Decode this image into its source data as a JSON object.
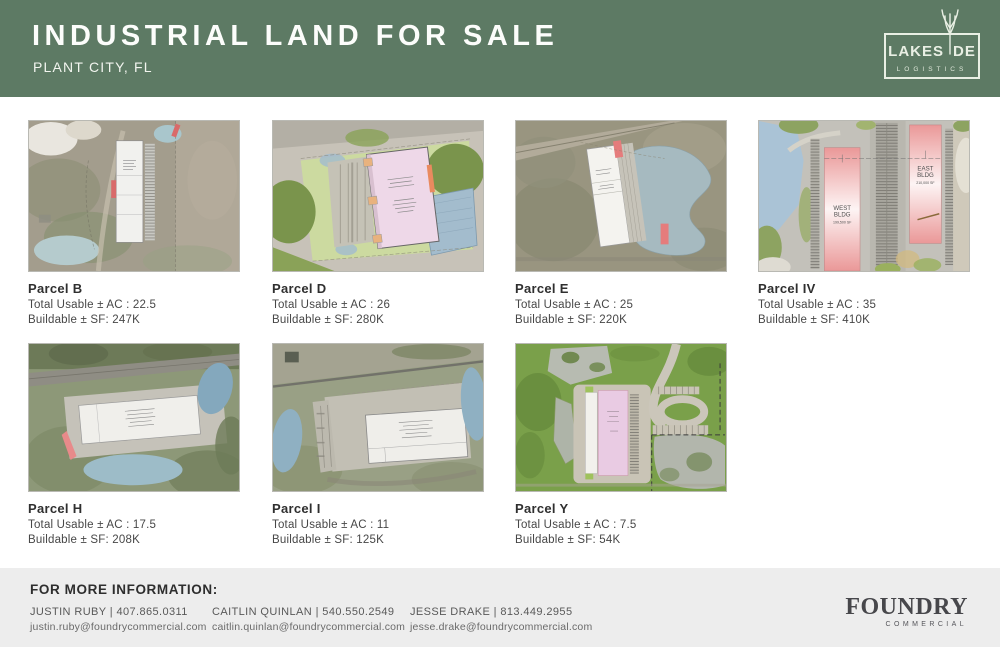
{
  "header": {
    "title": "INDUSTRIAL LAND FOR SALE",
    "subtitle": "PLANT CITY, FL",
    "logo": {
      "word_left": "LAKES",
      "word_right": "DE",
      "sub": "LOGISTICS"
    }
  },
  "parcels": [
    {
      "name": "Parcel B",
      "acres": "Total Usable ± AC : 22.5",
      "sf": "Buildable ± SF: 247K"
    },
    {
      "name": "Parcel D",
      "acres": "Total Usable ± AC : 26",
      "sf": "Buildable ± SF: 280K"
    },
    {
      "name": "Parcel E",
      "acres": "Total Usable ± AC : 25",
      "sf": "Buildable ± SF: 220K"
    },
    {
      "name": "Parcel IV",
      "acres": "Total Usable ± AC : 35",
      "sf": "Buildable ± SF: 410K"
    },
    {
      "name": "Parcel H",
      "acres": "Total Usable ± AC : 17.5",
      "sf": "Buildable ± SF: 208K"
    },
    {
      "name": "Parcel I",
      "acres": "Total Usable ± AC : 11",
      "sf": "Buildable ± SF: 125K"
    },
    {
      "name": "Parcel Y",
      "acres": "Total Usable ± AC : 7.5",
      "sf": "Buildable ± SF: 54K"
    }
  ],
  "parcel_iv_labels": {
    "west": {
      "l1": "WEST",
      "l2": "BLDG",
      "l3": "199,500 SF"
    },
    "east": {
      "l1": "EAST",
      "l2": "BLDG",
      "l3": "210,000 SF"
    }
  },
  "footer": {
    "heading": "FOR MORE INFORMATION:",
    "contacts": [
      {
        "name_phone": "JUSTIN RUBY | 407.865.0311",
        "email": "justin.ruby@foundrycommercial.com"
      },
      {
        "name_phone": "CAITLIN QUINLAN | 540.550.2549",
        "email": "caitlin.quinlan@foundrycommercial.com"
      },
      {
        "name_phone": "JESSE DRAKE | 813.449.2955",
        "email": "jesse.drake@foundrycommercial.com"
      }
    ],
    "logo": {
      "title": "FOUNDRY",
      "subtitle": "COMMERCIAL"
    }
  },
  "colors": {
    "header_green": "#5d7a64",
    "footer_gray": "#ededed",
    "logo_cream": "#e9efe4",
    "building_red": "#ea9898",
    "accent_red": "#e57c7c",
    "foundry_gray": "#47474b"
  }
}
